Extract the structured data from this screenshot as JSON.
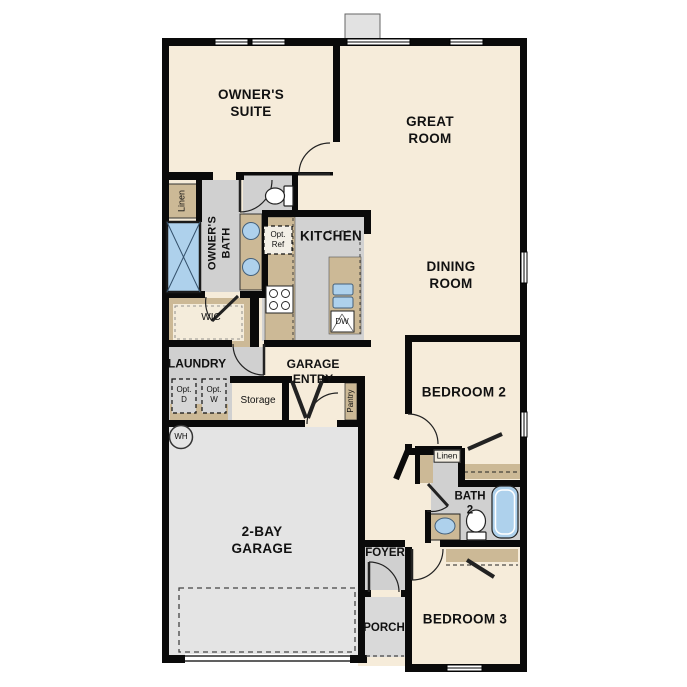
{
  "rooms": {
    "owners_suite": {
      "line1": "OWNER'S",
      "line2": "SUITE"
    },
    "great_room": {
      "line1": "GREAT",
      "line2": "ROOM"
    },
    "dining_room": {
      "line1": "DINING",
      "line2": "ROOM"
    },
    "kitchen": {
      "label": "KITCHEN"
    },
    "owners_bath": {
      "line1": "OWNER'S",
      "line2": "BATH"
    },
    "wic": {
      "label": "WIC"
    },
    "laundry": {
      "label": "LAUNDRY"
    },
    "storage": {
      "label": "Storage"
    },
    "garage_entry": {
      "line1": "GARAGE",
      "line2": "ENTRY"
    },
    "pantry": {
      "label": "Pantry"
    },
    "bedroom_2": {
      "label": "BEDROOM 2"
    },
    "bedroom_3": {
      "label": "BEDROOM 3"
    },
    "bath_2": {
      "line1": "BATH",
      "line2": "2"
    },
    "garage": {
      "line1": "2-BAY",
      "line2": "GARAGE"
    },
    "foyer": {
      "label": "FOYER"
    },
    "porch": {
      "label": "PORCH"
    },
    "linen_owners": {
      "label": "Linen"
    },
    "linen_hall": {
      "label": "Linen"
    }
  },
  "appliances": {
    "opt_ref": {
      "line1": "Opt.",
      "line2": "Ref"
    },
    "opt_dryer": {
      "line1": "Opt.",
      "line2": "D"
    },
    "opt_washer": {
      "line1": "Opt.",
      "line2": "W"
    },
    "dishwasher": {
      "label": "DW"
    },
    "water_heater": {
      "label": "WH"
    }
  },
  "colors": {
    "floor_main": "#f6ecda",
    "floor_wet": "#d0d0d0",
    "floor_garage": "#e4e4e4",
    "floor_porch": "#d9d9d9",
    "cabinet_tan": "#ccb996",
    "fixture_blue": "#aed1ec",
    "wall": "#0a0a0a"
  }
}
